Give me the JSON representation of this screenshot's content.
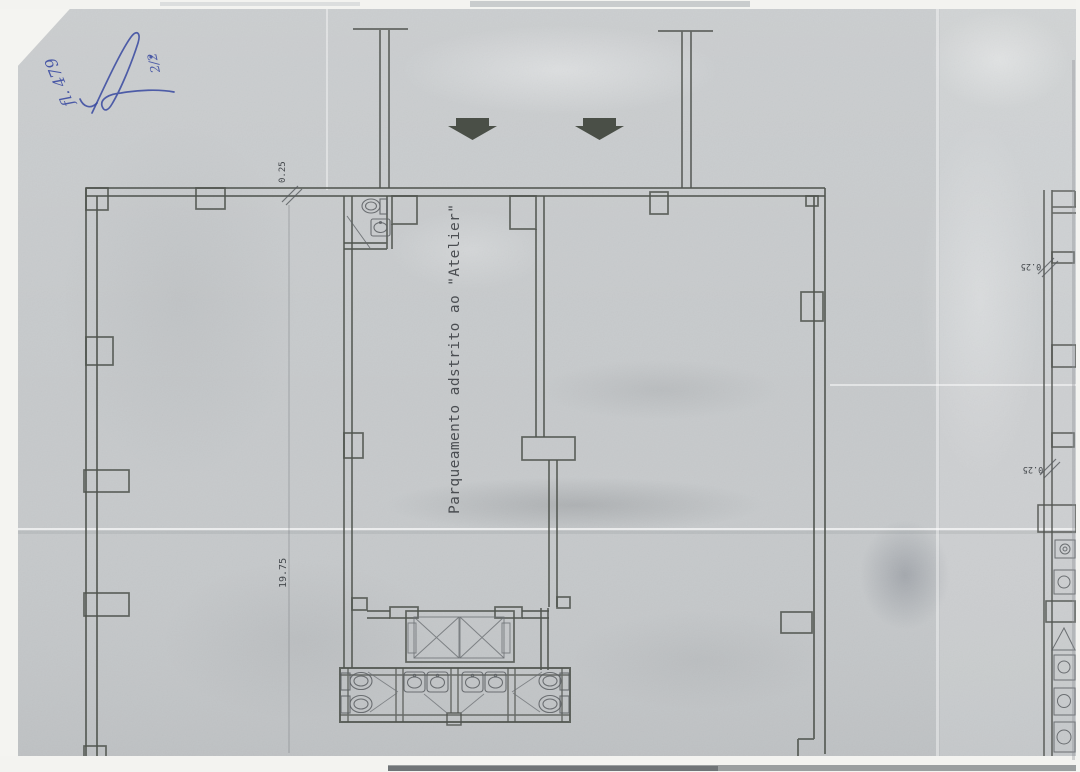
{
  "handwriting": {
    "folio_label": "fl. 479",
    "sheet_fraction": "2/2",
    "ink_color": "#3748a0"
  },
  "plan": {
    "room_label": "Parqueamento adstrito ao \"Atelier\"",
    "dimensions": {
      "top_wall_thickness": "0.25",
      "left_side_length": "19.75"
    },
    "adjacent_sheet": {
      "upper_dimension": "0.25",
      "lower_dimension": "0.25"
    },
    "colors": {
      "paper": "#c6c9cb",
      "drawing_line": "#50544f",
      "arrow_fill": "#3f443c",
      "ink_blue": "#3748a0"
    },
    "icons": {
      "down-arrow": "solid polygon arrow pointing down (entrance direction)",
      "toilet": "ellipse bowl with rectangular tank",
      "sink": "rounded square basin with oval and faucet dot",
      "elevator-x": "shaft rectangle with corner-to-corner diagonals",
      "door-swing": "thin diagonal line"
    }
  }
}
